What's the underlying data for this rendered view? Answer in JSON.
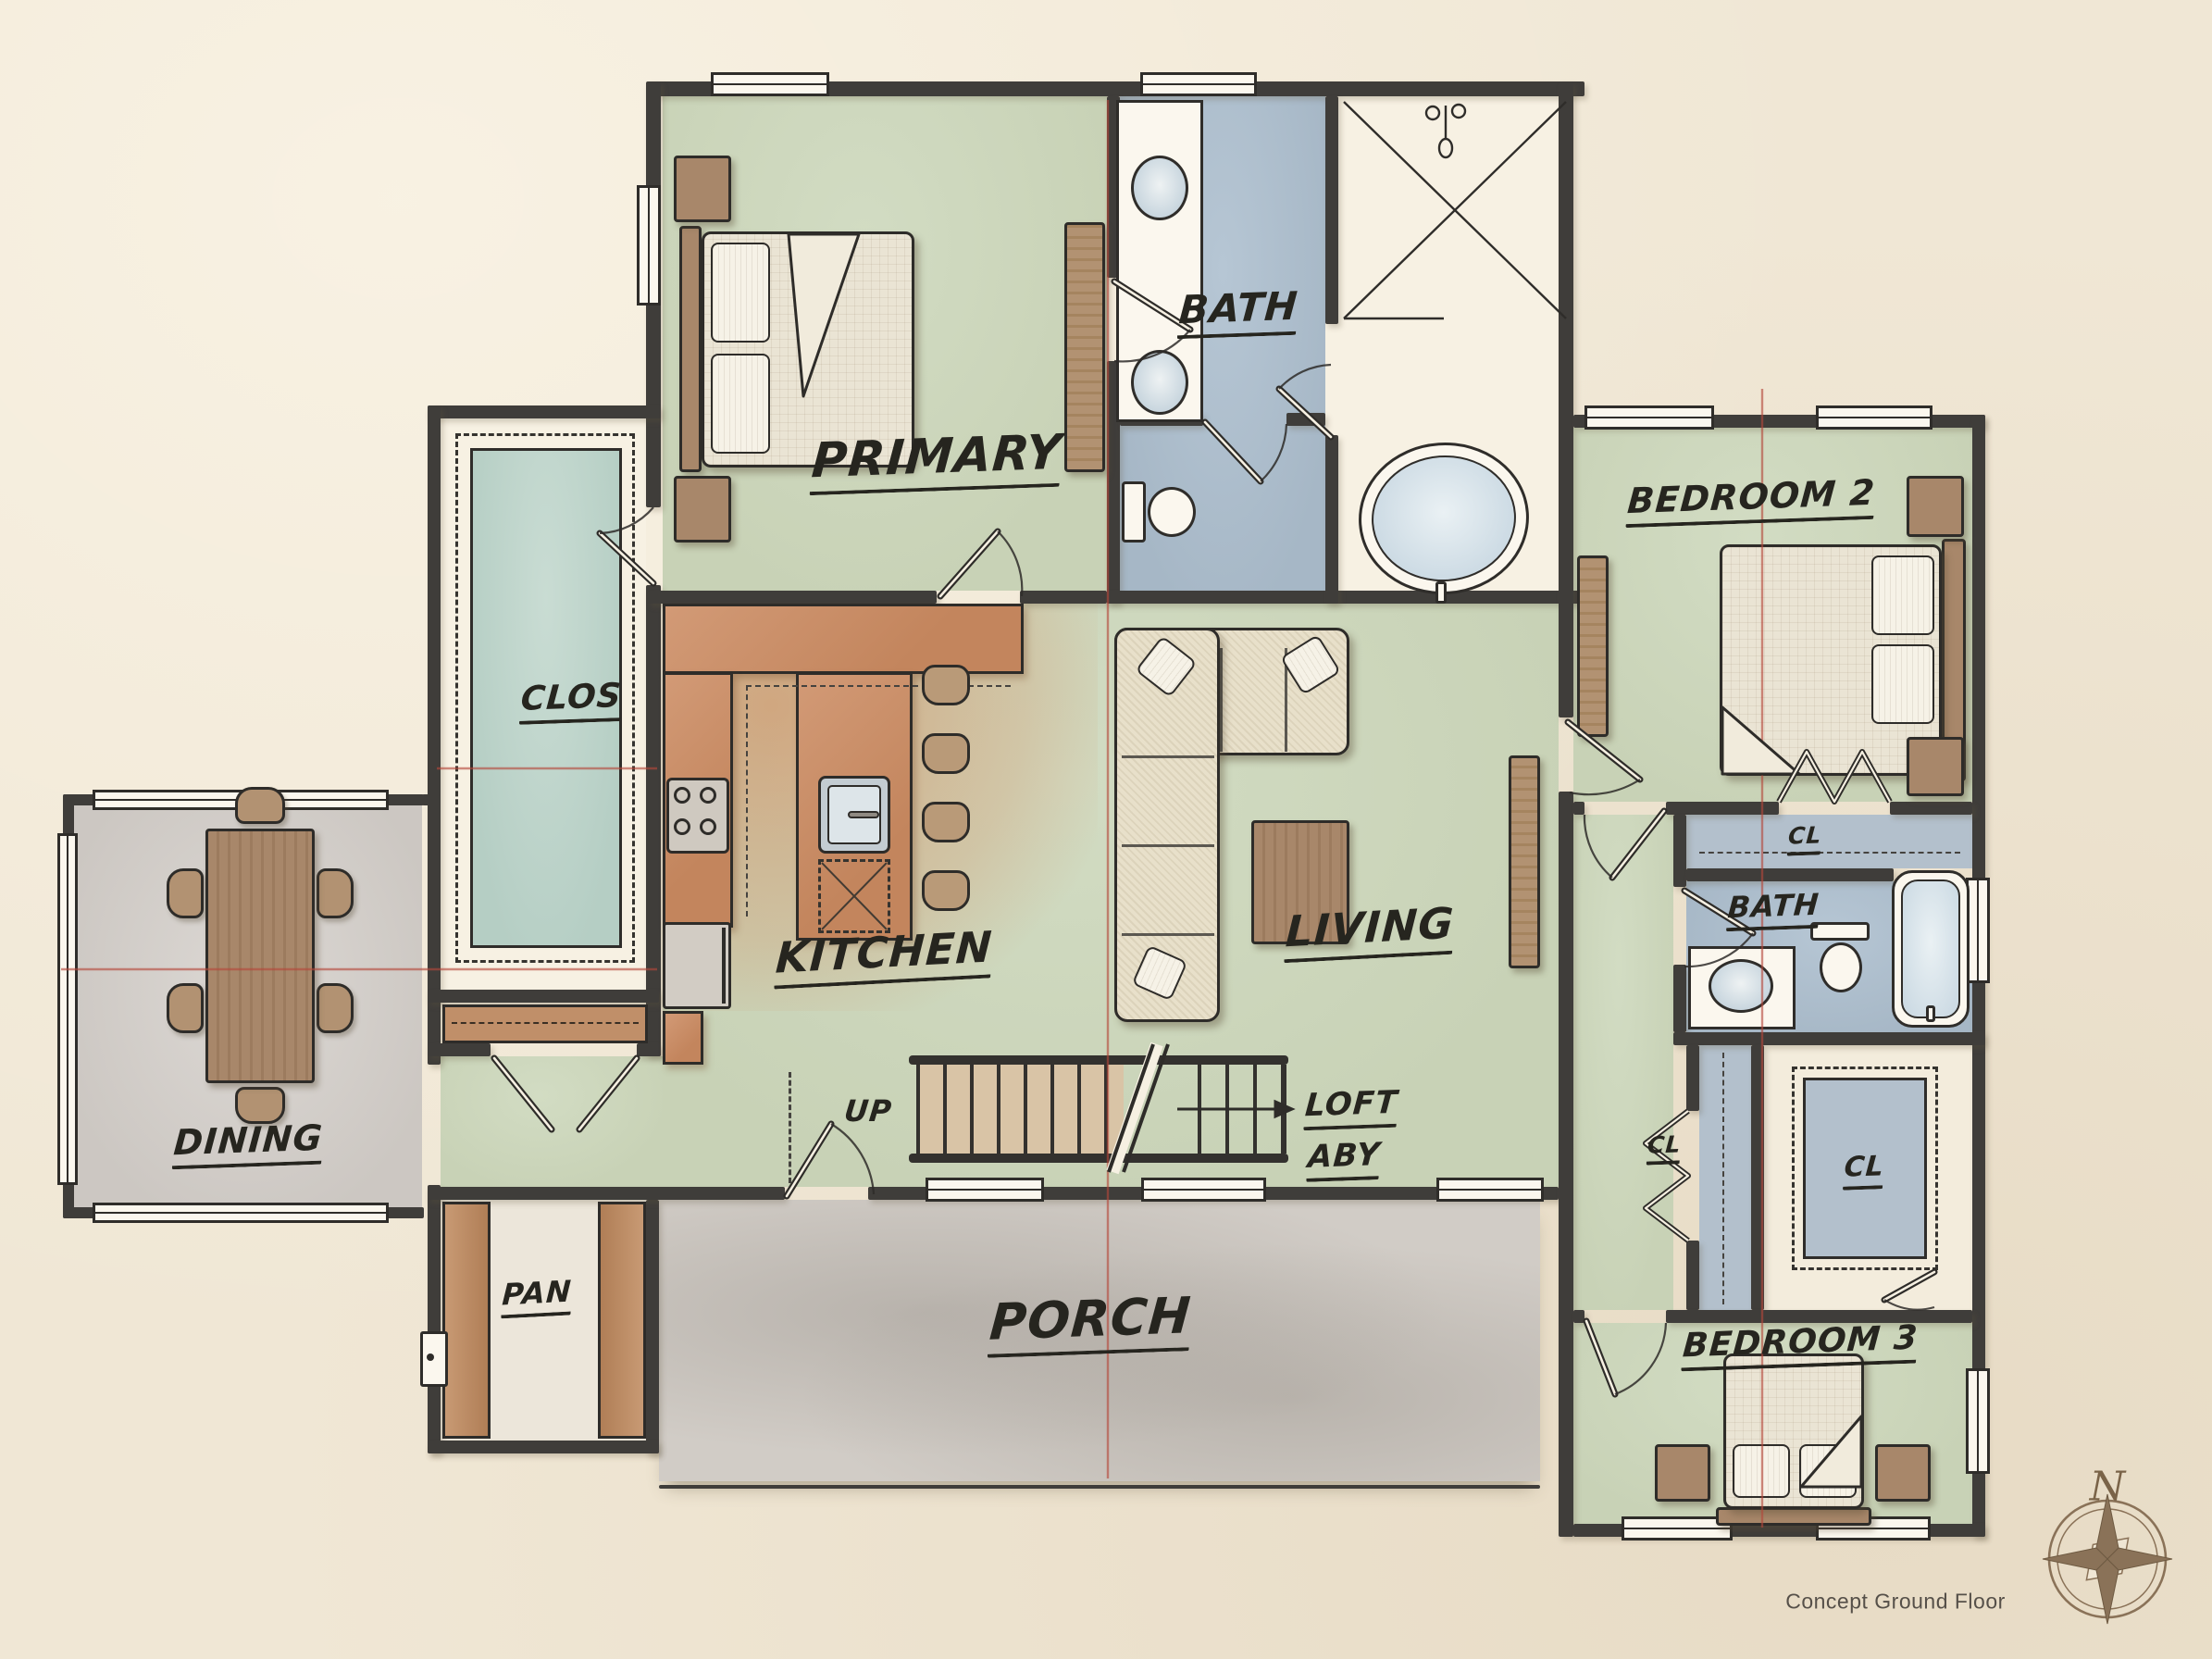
{
  "plan": {
    "rooms": {
      "primary": "PRIMARY",
      "primary_bath": "BATH",
      "bedroom2": "BEDROOM 2",
      "clos": "CLOS",
      "kitchen": "KITCHEN",
      "living": "LIVING",
      "dining": "DINING",
      "bath2": "BATH",
      "cl_linen": "CL",
      "cl_hall": "CL",
      "cl_bedroom3": "CL",
      "bedroom3": "BEDROOM 3",
      "pan": "PAN",
      "porch": "PORCH"
    },
    "stairs": {
      "up": "UP",
      "loft_line1": "LOFT",
      "loft_line2": "ABY"
    },
    "compass": {
      "north": "N"
    },
    "footer": {
      "caption": "Concept Ground Floor"
    },
    "colors": {
      "paper": "#f0e7d5",
      "wall": "#3f3d3a",
      "floor_green": "#ccd6bd",
      "floor_blue": "#aebfce",
      "floor_teal": "#bdd3ca",
      "floor_gray": "#d7d3cf",
      "porch_gray": "#cfcac4",
      "counter_orange": "#cd9672",
      "wood_brown": "#a8876a",
      "section_line_red": "#b5473a",
      "label_ink": "#26251f"
    }
  }
}
